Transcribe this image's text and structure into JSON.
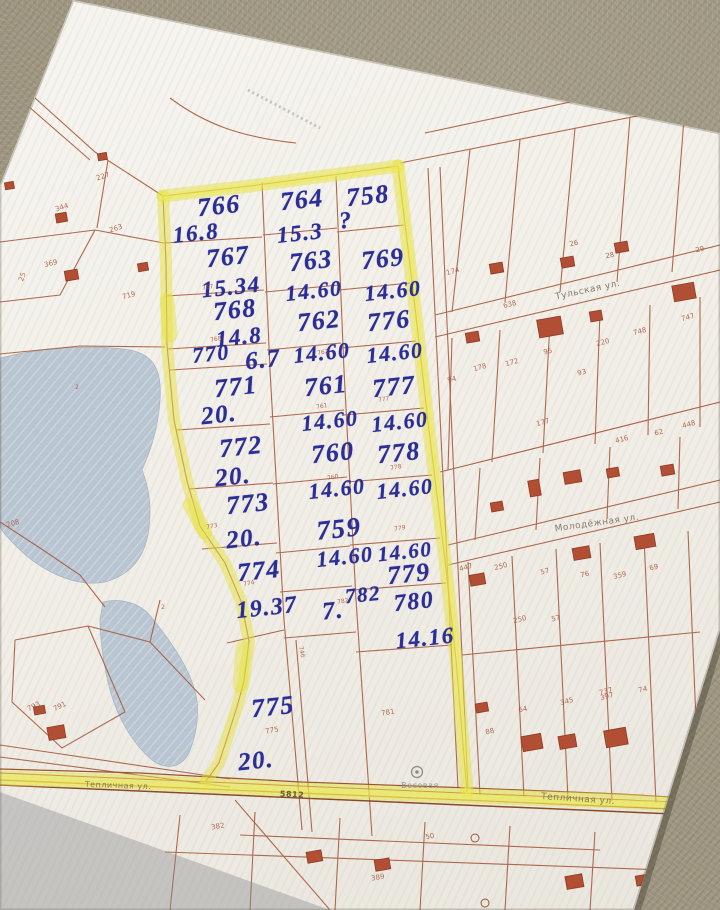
{
  "colors": {
    "carpet": "#9c947e",
    "paper": "#f2efe9",
    "parcel_line": "#a75b3e",
    "building": "#b14e33",
    "pond": "#b9c6d2",
    "highlighter": "#e6e23e",
    "ink": "#2b2e96",
    "printed_text": "#a6543a",
    "street_text": "#7d6e5e"
  },
  "map": {
    "label_layers": [
      {
        "name": "handwritten-plot-number",
        "class": "hw",
        "items": [
          {
            "t": "766",
            "x": 219,
            "y": 206,
            "s": 26,
            "r": -6
          },
          {
            "t": "16.8",
            "x": 196,
            "y": 233,
            "s": 23,
            "r": -6
          },
          {
            "t": "767",
            "x": 228,
            "y": 257,
            "s": 26,
            "r": -6
          },
          {
            "t": "15.34",
            "x": 231,
            "y": 287,
            "s": 23,
            "r": -6
          },
          {
            "t": "768",
            "x": 235,
            "y": 310,
            "s": 26,
            "r": -6
          },
          {
            "t": "14.8",
            "x": 239,
            "y": 337,
            "s": 23,
            "r": -6
          },
          {
            "t": "770",
            "x": 211,
            "y": 354,
            "s": 22,
            "r": -6
          },
          {
            "t": "6.7",
            "x": 263,
            "y": 360,
            "s": 25,
            "r": -6
          },
          {
            "t": "771",
            "x": 236,
            "y": 387,
            "s": 26,
            "r": -6
          },
          {
            "t": "20.",
            "x": 219,
            "y": 415,
            "s": 25,
            "r": -6
          },
          {
            "t": "772",
            "x": 241,
            "y": 447,
            "s": 26,
            "r": -6
          },
          {
            "t": "20.",
            "x": 233,
            "y": 477,
            "s": 25,
            "r": -6
          },
          {
            "t": "773",
            "x": 248,
            "y": 504,
            "s": 26,
            "r": -6
          },
          {
            "t": "20.",
            "x": 244,
            "y": 539,
            "s": 25,
            "r": -6
          },
          {
            "t": "774",
            "x": 259,
            "y": 571,
            "s": 26,
            "r": -6
          },
          {
            "t": "19.37",
            "x": 267,
            "y": 608,
            "s": 24,
            "r": -6
          },
          {
            "t": "775",
            "x": 273,
            "y": 707,
            "s": 26,
            "r": -6
          },
          {
            "t": "20.",
            "x": 256,
            "y": 761,
            "s": 25,
            "r": -6
          },
          {
            "t": "764",
            "x": 302,
            "y": 200,
            "s": 26,
            "r": -6
          },
          {
            "t": "15.3",
            "x": 300,
            "y": 233,
            "s": 23,
            "r": -6
          },
          {
            "t": "763",
            "x": 311,
            "y": 261,
            "s": 26,
            "r": -6
          },
          {
            "t": "14.60",
            "x": 314,
            "y": 291,
            "s": 22,
            "r": -6
          },
          {
            "t": "762",
            "x": 319,
            "y": 321,
            "s": 26,
            "r": -6
          },
          {
            "t": "14.60",
            "x": 322,
            "y": 353,
            "s": 22,
            "r": -6
          },
          {
            "t": "761",
            "x": 326,
            "y": 386,
            "s": 26,
            "r": -6
          },
          {
            "t": "14.60",
            "x": 330,
            "y": 421,
            "s": 22,
            "r": -6
          },
          {
            "t": "760",
            "x": 333,
            "y": 453,
            "s": 26,
            "r": -6
          },
          {
            "t": "14.60",
            "x": 337,
            "y": 489,
            "s": 22,
            "r": -6
          },
          {
            "t": "759",
            "x": 339,
            "y": 529,
            "s": 27,
            "r": -6
          },
          {
            "t": "14.60",
            "x": 345,
            "y": 557,
            "s": 22,
            "r": -6
          },
          {
            "t": "782",
            "x": 363,
            "y": 595,
            "s": 21,
            "r": -6
          },
          {
            "t": "7.",
            "x": 333,
            "y": 611,
            "s": 25,
            "r": -6
          },
          {
            "t": "758",
            "x": 368,
            "y": 196,
            "s": 26,
            "r": -6
          },
          {
            "t": "?",
            "x": 346,
            "y": 221,
            "s": 24,
            "r": -6
          },
          {
            "t": "769",
            "x": 383,
            "y": 259,
            "s": 26,
            "r": -6
          },
          {
            "t": "14.60",
            "x": 393,
            "y": 291,
            "s": 22,
            "r": -6
          },
          {
            "t": "776",
            "x": 389,
            "y": 321,
            "s": 26,
            "r": -6
          },
          {
            "t": "14.60",
            "x": 395,
            "y": 353,
            "s": 22,
            "r": -6
          },
          {
            "t": "777",
            "x": 394,
            "y": 387,
            "s": 26,
            "r": -6
          },
          {
            "t": "14.60",
            "x": 400,
            "y": 422,
            "s": 22,
            "r": -6
          },
          {
            "t": "778",
            "x": 399,
            "y": 453,
            "s": 26,
            "r": -6
          },
          {
            "t": "14.60",
            "x": 405,
            "y": 489,
            "s": 22,
            "r": -6
          },
          {
            "t": "14.60",
            "x": 405,
            "y": 552,
            "s": 21,
            "r": -6
          },
          {
            "t": "779",
            "x": 409,
            "y": 574,
            "s": 26,
            "r": -6
          },
          {
            "t": "780",
            "x": 414,
            "y": 602,
            "s": 24,
            "r": -6
          },
          {
            "t": "14.16",
            "x": 425,
            "y": 638,
            "s": 23,
            "r": -6
          }
        ]
      },
      {
        "name": "printed-parcel-number",
        "class": "printed",
        "items": [
          {
            "t": "227",
            "x": 103,
            "y": 177,
            "r": -18
          },
          {
            "t": "344",
            "x": 62,
            "y": 208,
            "r": -18
          },
          {
            "t": "263",
            "x": 116,
            "y": 229,
            "r": -18
          },
          {
            "t": "369",
            "x": 51,
            "y": 264,
            "r": -15
          },
          {
            "t": "719",
            "x": 129,
            "y": 296,
            "r": -15
          },
          {
            "t": "25",
            "x": 23,
            "y": 277,
            "r": -70
          },
          {
            "t": "208",
            "x": 13,
            "y": 524,
            "r": -15
          },
          {
            "t": "2",
            "x": 77,
            "y": 388,
            "s": 6,
            "r": 0
          },
          {
            "t": "2",
            "x": 163,
            "y": 608,
            "s": 6,
            "r": 0
          },
          {
            "t": "793",
            "x": 34,
            "y": 707,
            "r": -25
          },
          {
            "t": "791",
            "x": 60,
            "y": 707,
            "r": -25
          },
          {
            "t": "775",
            "x": 272,
            "y": 731,
            "r": -10
          },
          {
            "t": "781",
            "x": 388,
            "y": 713,
            "r": -10
          },
          {
            "t": "782",
            "x": 343,
            "y": 602,
            "s": 6,
            "r": -10
          },
          {
            "t": "774",
            "x": 249,
            "y": 584,
            "s": 6,
            "r": -10
          },
          {
            "t": "773",
            "x": 212,
            "y": 527,
            "s": 6,
            "r": -10
          },
          {
            "t": "767",
            "x": 208,
            "y": 288,
            "s": 6,
            "r": -10
          },
          {
            "t": "768",
            "x": 216,
            "y": 340,
            "s": 6,
            "r": -10
          },
          {
            "t": "762",
            "x": 323,
            "y": 353,
            "s": 6,
            "r": -10
          },
          {
            "t": "761",
            "x": 322,
            "y": 407,
            "s": 6,
            "r": -10
          },
          {
            "t": "760",
            "x": 333,
            "y": 478,
            "s": 6,
            "r": -10
          },
          {
            "t": "777",
            "x": 384,
            "y": 400,
            "s": 6,
            "r": -10
          },
          {
            "t": "778",
            "x": 396,
            "y": 468,
            "s": 6,
            "r": -10
          },
          {
            "t": "779",
            "x": 400,
            "y": 529,
            "s": 6,
            "r": -10
          },
          {
            "t": "746",
            "x": 301,
            "y": 652,
            "s": 6,
            "r": 78
          },
          {
            "t": "174",
            "x": 453,
            "y": 272,
            "r": -15
          },
          {
            "t": "638",
            "x": 510,
            "y": 305,
            "r": -15
          },
          {
            "t": "26",
            "x": 574,
            "y": 244,
            "r": -12
          },
          {
            "t": "28",
            "x": 610,
            "y": 256,
            "r": -12
          },
          {
            "t": "29",
            "x": 700,
            "y": 250,
            "r": -12
          },
          {
            "t": "220",
            "x": 603,
            "y": 343,
            "r": -14
          },
          {
            "t": "748",
            "x": 640,
            "y": 332,
            "r": -14
          },
          {
            "t": "747",
            "x": 688,
            "y": 318,
            "r": -14
          },
          {
            "t": "172",
            "x": 512,
            "y": 363,
            "r": -14
          },
          {
            "t": "178",
            "x": 480,
            "y": 368,
            "r": -14
          },
          {
            "t": "94",
            "x": 452,
            "y": 380,
            "r": -14
          },
          {
            "t": "95",
            "x": 548,
            "y": 352,
            "r": -14
          },
          {
            "t": "93",
            "x": 582,
            "y": 373,
            "r": -14
          },
          {
            "t": "177",
            "x": 543,
            "y": 423,
            "r": -14
          },
          {
            "t": "448",
            "x": 689,
            "y": 425,
            "r": -14
          },
          {
            "t": "416",
            "x": 622,
            "y": 440,
            "r": -14
          },
          {
            "t": "62",
            "x": 659,
            "y": 433,
            "r": -14
          },
          {
            "t": "447",
            "x": 466,
            "y": 568,
            "r": -14
          },
          {
            "t": "250",
            "x": 501,
            "y": 567,
            "r": -14
          },
          {
            "t": "57",
            "x": 545,
            "y": 572,
            "r": -14
          },
          {
            "t": "76",
            "x": 585,
            "y": 575,
            "r": -14
          },
          {
            "t": "359",
            "x": 620,
            "y": 576,
            "r": -14
          },
          {
            "t": "69",
            "x": 654,
            "y": 568,
            "r": -14
          },
          {
            "t": "250",
            "x": 520,
            "y": 620,
            "r": -14
          },
          {
            "t": "57",
            "x": 556,
            "y": 619,
            "r": -14
          },
          {
            "t": "397",
            "x": 607,
            "y": 697,
            "r": -14
          },
          {
            "t": "74",
            "x": 643,
            "y": 690,
            "r": -14
          },
          {
            "t": "737",
            "x": 606,
            "y": 692,
            "r": -14
          },
          {
            "t": "345",
            "x": 567,
            "y": 702,
            "r": -14
          },
          {
            "t": "64",
            "x": 523,
            "y": 710,
            "r": -14
          },
          {
            "t": "88",
            "x": 490,
            "y": 732,
            "r": -14
          },
          {
            "t": "382",
            "x": 218,
            "y": 827,
            "r": -10
          },
          {
            "t": "389",
            "x": 378,
            "y": 878,
            "r": -10
          },
          {
            "t": "50",
            "x": 430,
            "y": 837,
            "r": -10
          }
        ]
      },
      {
        "name": "street-label",
        "class": "street",
        "items": [
          {
            "t": "Тульская ул.",
            "x": 588,
            "y": 291,
            "s": 9,
            "r": -12
          },
          {
            "t": "Молодёжная ул.",
            "x": 597,
            "y": 524,
            "s": 9,
            "r": -8
          },
          {
            "t": "Тепличная ул.",
            "x": 118,
            "y": 786,
            "s": 8,
            "r": 2
          },
          {
            "t": "Тепличная ул.",
            "x": 578,
            "y": 800,
            "s": 9,
            "r": 4
          },
          {
            "t": "5812",
            "x": 292,
            "y": 795,
            "s": 8,
            "r": 3,
            "c": "#5a4a3a",
            "w": 700
          },
          {
            "t": "Весовая",
            "x": 420,
            "y": 786,
            "s": 8,
            "r": 0,
            "c": "#8a8a84"
          }
        ]
      }
    ]
  }
}
